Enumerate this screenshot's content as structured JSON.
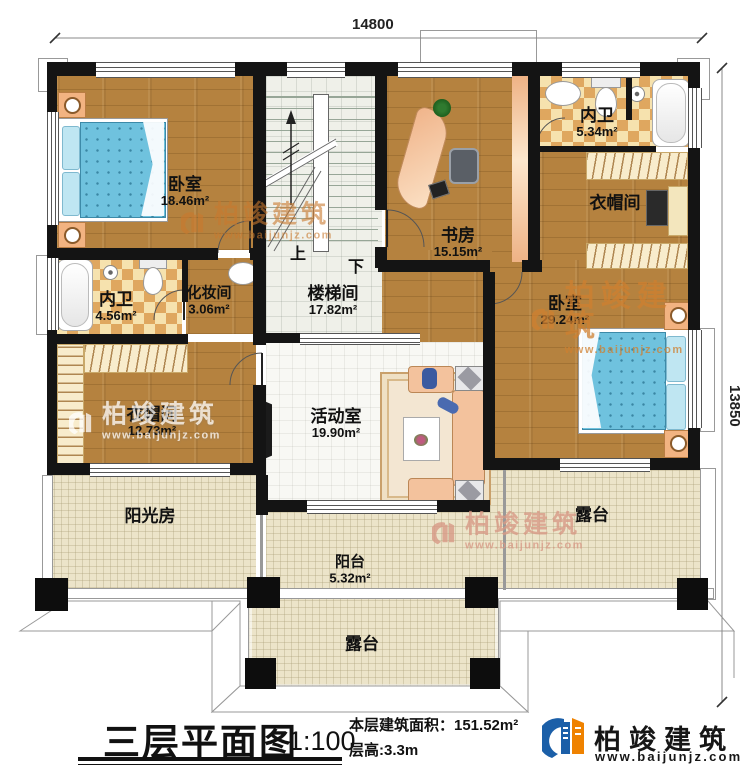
{
  "dimensions": {
    "width_mm": "14800",
    "height_mm": "13850"
  },
  "rooms": {
    "bedroom_left": {
      "name": "卧室",
      "area": "18.46m²"
    },
    "study": {
      "name": "书房",
      "area": "15.15m²"
    },
    "bath_top": {
      "name": "内卫",
      "area": "5.34m²"
    },
    "closet_right": {
      "name": "衣帽间"
    },
    "bedroom_right": {
      "name": "卧室",
      "area": "29.24m²"
    },
    "bath_left": {
      "name": "内卫",
      "area": "4.56m²"
    },
    "makeup": {
      "name": "化妆间",
      "area": "3.06m²"
    },
    "stairwell": {
      "name": "楼梯间",
      "area": "17.82m²"
    },
    "closet_left": {
      "name": "衣帽间",
      "area": "12.73m²"
    },
    "activity": {
      "name": "活动室",
      "area": "19.90m²"
    },
    "sunroom": {
      "name": "阳光房"
    },
    "balcony": {
      "name": "阳台",
      "area": "5.32m²"
    },
    "terrace_right": {
      "name": "露台"
    },
    "terrace_bottom": {
      "name": "露台"
    }
  },
  "stairs": {
    "up": "上",
    "down": "下"
  },
  "title_block": {
    "title": "三层平面图",
    "scale": "1:100",
    "floor_area": "本层建筑面积：151.52m²",
    "floor_height": "层高:3.3m"
  },
  "brand": {
    "name": "柏竣建筑",
    "website": "www.baijunjz.com"
  },
  "colors": {
    "wall": "#141414",
    "accent_blue": "#1b5fa8",
    "accent_orange": "#ef8200"
  }
}
